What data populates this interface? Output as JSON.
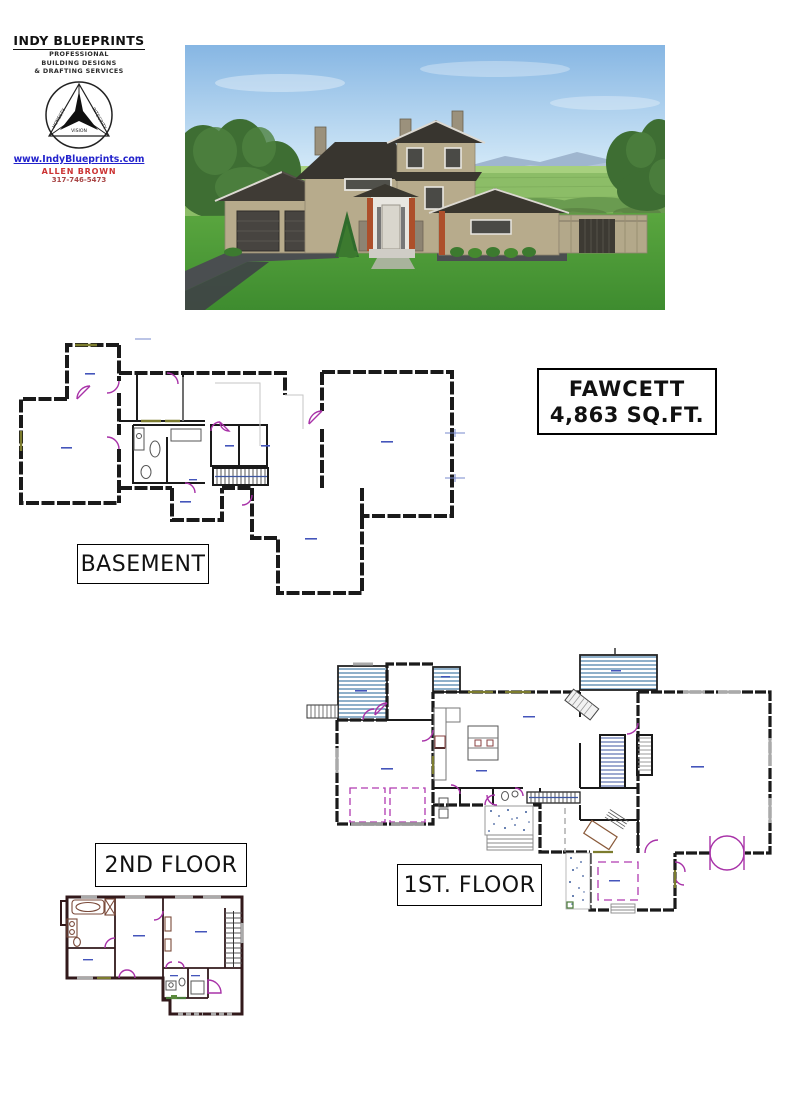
{
  "page": {
    "width": 800,
    "height": 1100,
    "background": "#ffffff"
  },
  "logo": {
    "company": "INDY BLUEPRINTS",
    "taglines": [
      "PROFESSIONAL",
      "BUILDING DESIGNS",
      "& DRAFTING SERVICES"
    ],
    "emblem_words": [
      "HONESTY",
      "INTEGRITY",
      "VISION"
    ],
    "website": "www.IndyBlueprints.com",
    "agent": "ALLEN BROWN",
    "phone": "317-746-5473"
  },
  "title_block": {
    "plan_name": "FAWCETT",
    "area": "4,863 SQ.FT."
  },
  "floor_labels": {
    "basement": "BASEMENT",
    "first": "1ST. FLOOR",
    "second": "2ND FLOOR"
  },
  "rendering": {
    "subject": "two-story house exterior rendering"
  },
  "colors": {
    "plan_wall": "#1a1a1a",
    "second_floor_wall": "#32191b",
    "door_swing": "#a832a8",
    "deck_stripe": "#8fb0ca",
    "stair_accent": "#3c55a0",
    "speckle": "#3a5a9a",
    "sill_olive": "#7c7c2e",
    "sill_green": "#4a7a3a",
    "website_text": "#2222cc",
    "agent_text": "#cc3333",
    "sky": "#8ab8e4",
    "lawn": "#4d9c3b",
    "roof": "#38352f",
    "siding": "#b7ab8c",
    "accent_post": "#ad4f2b"
  }
}
